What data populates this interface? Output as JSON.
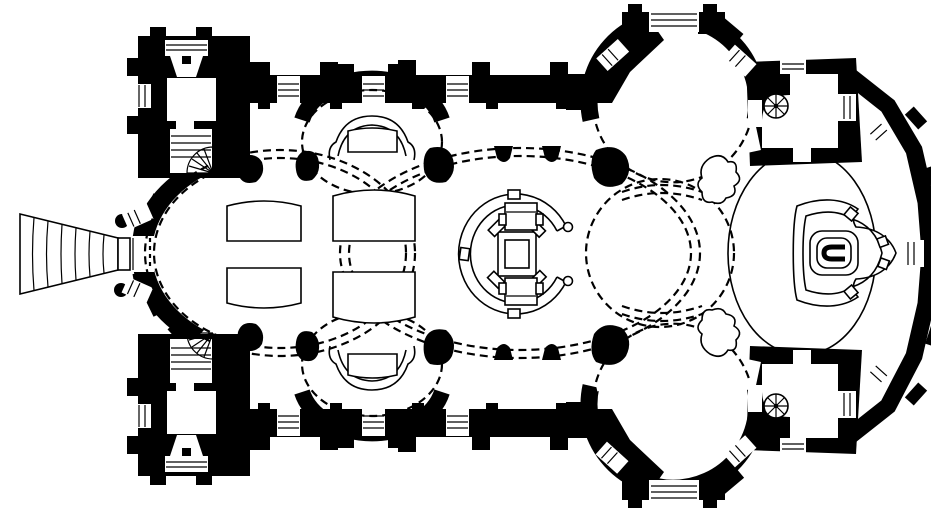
{
  "figure": {
    "kind": "architectural-floor-plan",
    "subject": "baroque-pilgrimage-church-ground-plan",
    "orientation": "entrance-left-apse-right"
  },
  "canvas": {
    "width": 931,
    "height": 512
  },
  "colors": {
    "ink": "#000000",
    "paper": "#ffffff"
  },
  "style": {
    "thin": "1.6",
    "dashw": "2.2",
    "dash": "8 5"
  },
  "features": [
    "entrance-stair-fan",
    "west-portal",
    "flanking-columns",
    "northwest-tower",
    "southwest-tower",
    "tower-stair",
    "winder-stair-fan",
    "west-oval-nave",
    "pew-blocks",
    "north-side-chapel",
    "south-side-chapel",
    "chapel-altar",
    "central-oval-nave",
    "central-shrine-altar",
    "shrine-canopy",
    "crossing-rotunda",
    "north-transept-rotunda",
    "south-transept-rotunda",
    "tripartite-window",
    "splayed-window",
    "northeast-sacristy",
    "southeast-sacristy",
    "spiral-stair",
    "choir-oval",
    "apse",
    "high-altar-platform",
    "high-altar",
    "vault-projection-dashed-lines",
    "pier",
    "pilaster"
  ]
}
